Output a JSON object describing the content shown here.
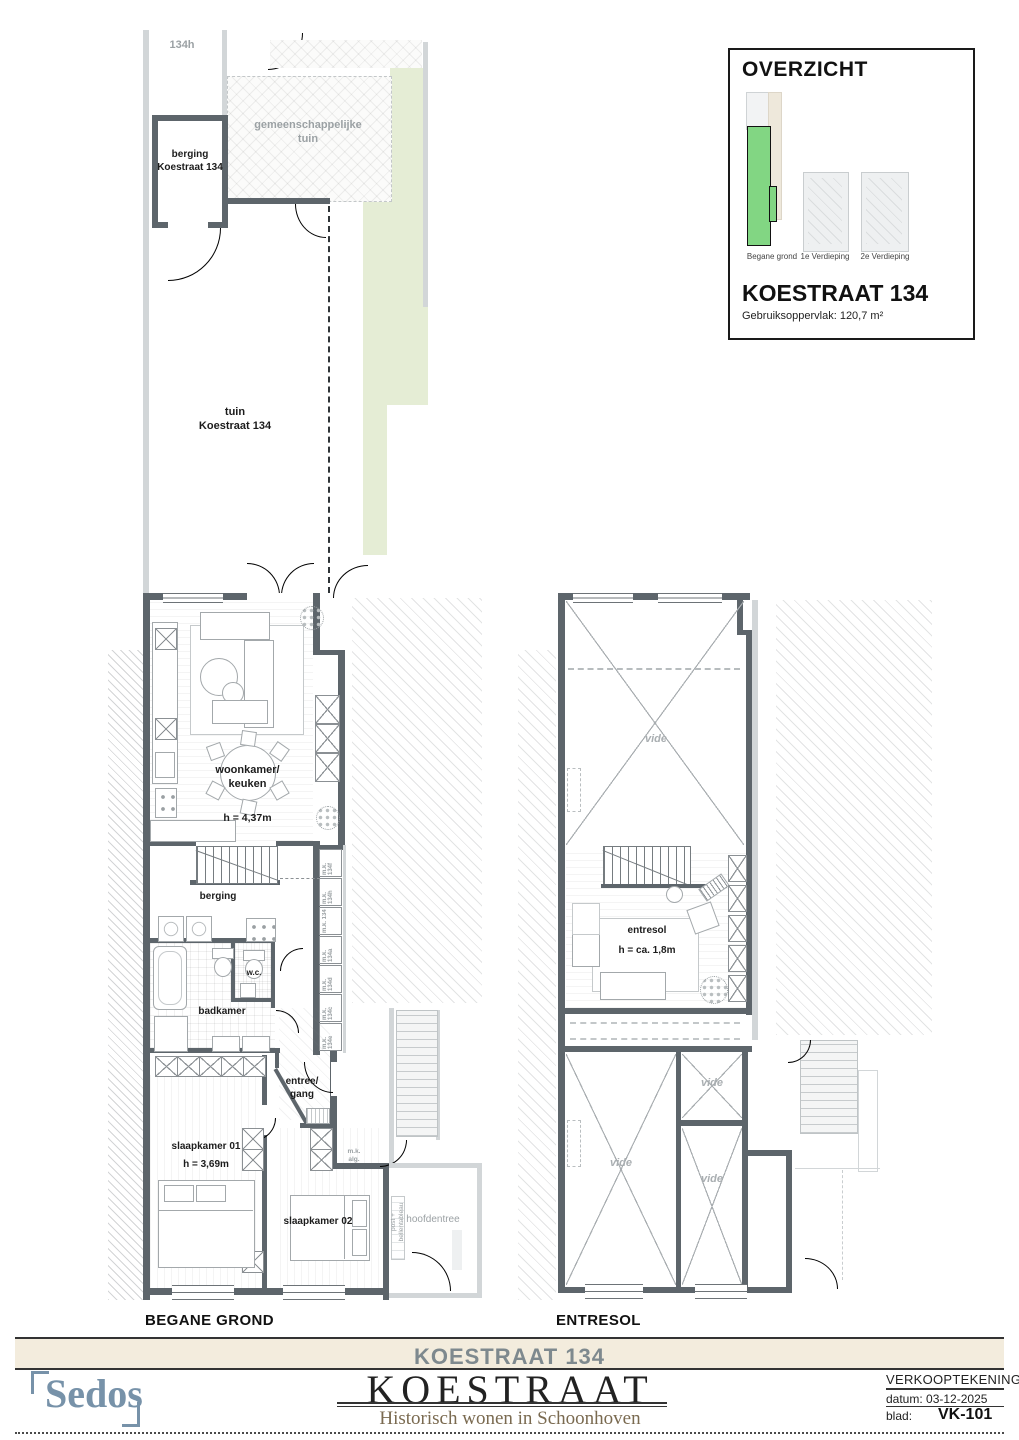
{
  "overview": {
    "title": "OVERZICHT",
    "floor_labels": [
      "Begane grond",
      "1e Verdieping",
      "2e Verdieping"
    ],
    "building": "KOESTRAAT 134",
    "area": "Gebruiksoppervlak: 120,7 m²"
  },
  "garden": {
    "neighbor": "134h",
    "shed": "berging\nKoestraat 134",
    "common": "gemeenschappelijke\ntuin",
    "private": "tuin\nKoestraat 134"
  },
  "ground": {
    "caption": "BEGANE GROND",
    "living": "woonkamer/\nkeuken",
    "living_h": "h = 4,37m",
    "storage": "berging",
    "wc": "w.c.",
    "bath": "badkamer",
    "hall": "entree/\ngang",
    "bed1": "slaapkamer 01",
    "bed1_h": "h = 3,69m",
    "bed2": "slaapkamer 02",
    "mk": [
      "m.k. 134f",
      "m.k. 134h",
      "m.k. 134",
      "m.k. 134a",
      "m.k. 134d",
      "m.k. 134c",
      "m.k. 134e"
    ],
    "mk_alg": "m.k.\nalg.",
    "entrance": "hoofdentree",
    "post": "post +\nbellentableau"
  },
  "entresol": {
    "caption": "ENTRESOL",
    "room": "entresol",
    "room_h": "h = ca. 1,8m",
    "vide": [
      "vide",
      "vide",
      "vide",
      "vide"
    ]
  },
  "titleblock": {
    "banner": "KOESTRAAT 134",
    "logo": "Sedos",
    "brand": "KOESTRAAT",
    "tagline": "Historisch wonen in Schoonhoven",
    "doc": "VERKOOPTEKENING",
    "date_label": "datum:",
    "date": "03-12-2025",
    "sheet_label": "blad:",
    "sheet": "VK-101"
  },
  "colors": {
    "wall": "#5d656b",
    "wall_light": "#d2d6d8",
    "garden_green": "#e5edd5",
    "highlight_green": "#82d683",
    "band_beige": "#f3ecdd",
    "logo_blue": "#7792a9",
    "tagline_brown": "#7a6a50"
  }
}
